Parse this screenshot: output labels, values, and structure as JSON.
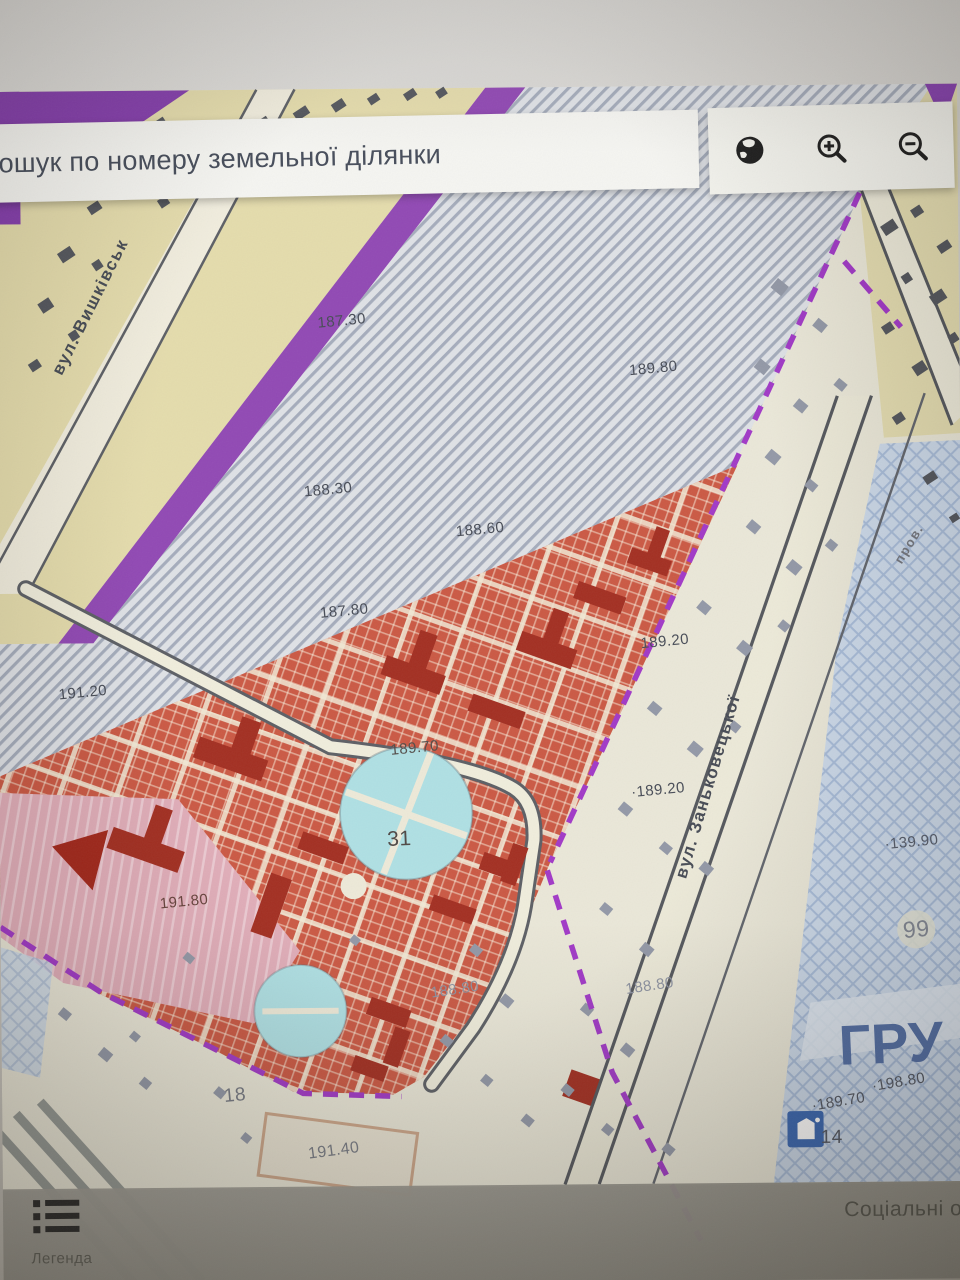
{
  "search": {
    "placeholder": "Пошук по номеру земельної ділянки"
  },
  "toolbar": {
    "icons": [
      {
        "name": "globe-icon"
      },
      {
        "name": "zoom-in-icon"
      },
      {
        "name": "zoom-out-icon"
      }
    ]
  },
  "footer": {
    "legend_label": "Легенда",
    "right_text": "Соціальні об"
  },
  "map": {
    "colors": {
      "purple_zone": "#7e34a8",
      "boundary_dash": "#9c2fc4",
      "parcel_hatch": "#a0a8b8",
      "red_zone": "#c8503a",
      "dark_building": "#9e2416",
      "park_blue": "#abdee2",
      "blue_hatch_zone": "#c9d7e8",
      "tan_zone": "#e2daac",
      "big_label_blue": "#4a68a2"
    },
    "street_labels": [
      {
        "text": "вул. Вишківськ",
        "x": 95,
        "y": 305,
        "rot": -63
      },
      {
        "text": "вул. Заньковецької",
        "x": 706,
        "y": 788,
        "rot": -73
      },
      {
        "text": "пров.",
        "x": 908,
        "y": 548,
        "rot": -58,
        "size": 13,
        "color": "#6b6e76"
      }
    ],
    "labels": [
      {
        "text": "187.30",
        "x": 345,
        "y": 321
      },
      {
        "text": "189.80",
        "x": 655,
        "y": 371
      },
      {
        "text": "188.30",
        "x": 330,
        "y": 489
      },
      {
        "text": "188.60",
        "x": 481,
        "y": 530
      },
      {
        "text": "187.80",
        "x": 345,
        "y": 610
      },
      {
        "text": "191.20",
        "x": 84,
        "y": 689
      },
      {
        "text": "189.20",
        "x": 664,
        "y": 643
      },
      {
        "text": "189.70",
        "x": 414,
        "y": 747,
        "color": "#4a4440"
      },
      {
        "text": "·189.20",
        "x": 656,
        "y": 791
      },
      {
        "text": "·139.90",
        "x": 908,
        "y": 845,
        "color": "#4e5564"
      },
      {
        "text": "99",
        "x": 912,
        "y": 932,
        "size": 23,
        "color": "#7b818e"
      },
      {
        "text": "31",
        "x": 398,
        "y": 838,
        "size": 21,
        "color": "#463f3c",
        "rot": -2
      },
      {
        "text": "191.80",
        "x": 183,
        "y": 898,
        "color": "#5f3a33"
      },
      {
        "text": "188.80",
        "x": 452,
        "y": 988,
        "color": "#878d9c",
        "rot": -8
      },
      {
        "text": "188.80",
        "x": 646,
        "y": 986,
        "color": "#878d9c",
        "rot": -8
      },
      {
        "text": "18",
        "x": 232,
        "y": 1092,
        "size": 19,
        "color": "#6e727c"
      },
      {
        "text": "191.40",
        "x": 330,
        "y": 1148,
        "size": 16,
        "color": "#70747e",
        "rot": -7
      },
      {
        "text": "·189.70",
        "x": 833,
        "y": 1103,
        "rot": -9,
        "color": "#494e59"
      },
      {
        "text": "·198.80",
        "x": 893,
        "y": 1084,
        "rot": -9,
        "color": "#494e59"
      },
      {
        "text": "14",
        "x": 826,
        "y": 1139,
        "size": 19,
        "color": "#4a4f5a",
        "rot": 0
      },
      {
        "text": "ГРУ",
        "x": 886,
        "y": 1045,
        "size": 56,
        "color": "#4a68a2",
        "rot": -2,
        "bold": true
      }
    ],
    "poi": {
      "monument_number": "14"
    }
  }
}
